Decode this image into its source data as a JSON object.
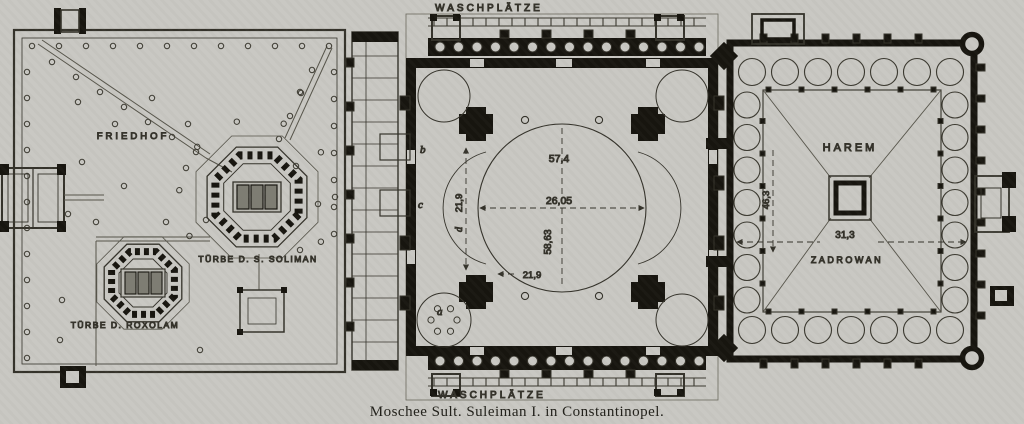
{
  "caption": "Moschee Sult. Suleiman I. in Constantinopel.",
  "labels": {
    "waschplaetze_top": "WASCHPLÄTZE",
    "waschplaetze_bottom": "WASCHPLÄTZE",
    "friedhof": "FRIEDHOF",
    "tuerbe_soliman": "TÜRBE D. S. SOLIMAN",
    "tuerbe_roxolam": "TÜRBE D. ROXOLAM",
    "harem": "HAREM",
    "zadrowan": "ZADROWAN"
  },
  "measurements": {
    "hall_width": "57,4",
    "dome_diameter": "26,05",
    "hall_depth": "58,63",
    "aisle_left": "21,9",
    "aisle_bottom": "21,9",
    "court_depth": "46,3",
    "court_width": "31,3"
  },
  "markers": {
    "a": "a",
    "b": "b",
    "c": "c",
    "d": "d"
  },
  "colors": {
    "paper": "#c9c8c3",
    "ink": "#17150f",
    "line": "#3a382f"
  }
}
